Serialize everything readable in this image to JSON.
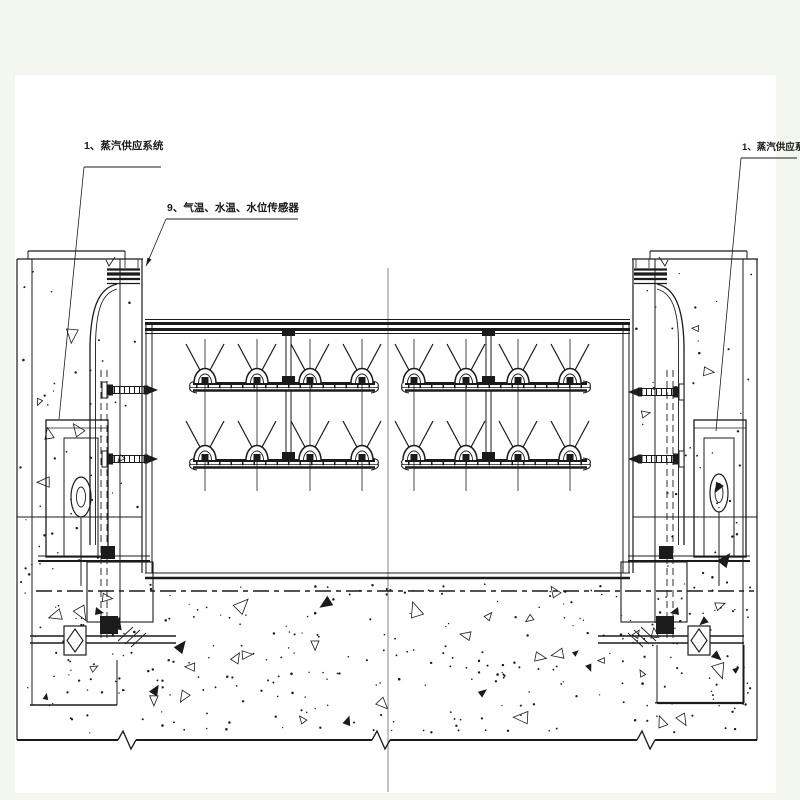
{
  "colors": {
    "page_background": "#f4f7f0",
    "sheet_background": "#ffffff",
    "ink": "#1b1b1b",
    "faint_line": "#7a7a7a"
  },
  "annotations": {
    "left_steam_label": "1、蒸汽供应系统",
    "sensor_label": "9、气温、水温、水位传感器",
    "right_steam_label": "1、蒸汽供应系统"
  }
}
